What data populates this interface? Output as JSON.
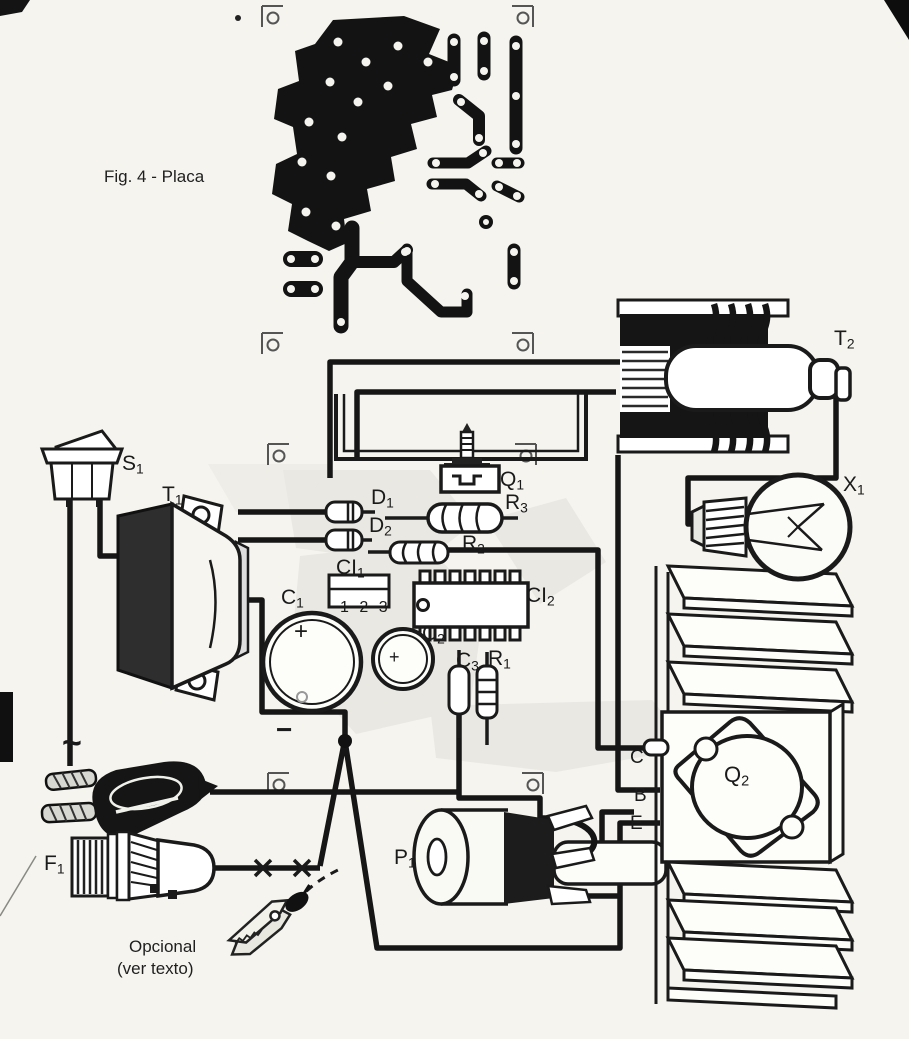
{
  "figure": {
    "caption": "Fig. 4 - Placa"
  },
  "notes": {
    "optional_line1": "Opcional",
    "optional_line2": "(ver texto)"
  },
  "colors": {
    "ink": "#1a1a1a",
    "paper": "#f5f4ef",
    "copper": "#131313",
    "watermark": "#e0dfd8"
  },
  "component_labels": [
    {
      "id": "s1",
      "main": "S",
      "sub": "1",
      "x": 122,
      "y": 453,
      "size": 21
    },
    {
      "id": "t1",
      "main": "T",
      "sub": "1",
      "x": 162,
      "y": 484,
      "size": 21
    },
    {
      "id": "t2",
      "main": "T",
      "sub": "2",
      "x": 834,
      "y": 328,
      "size": 21
    },
    {
      "id": "q1",
      "main": "Q",
      "sub": "1",
      "x": 500,
      "y": 469,
      "size": 21
    },
    {
      "id": "d1",
      "main": "D",
      "sub": "1",
      "x": 371,
      "y": 487,
      "size": 21
    },
    {
      "id": "d2",
      "main": "D",
      "sub": "2",
      "x": 369,
      "y": 515,
      "size": 21
    },
    {
      "id": "r3",
      "main": "R",
      "sub": "3",
      "x": 505,
      "y": 492,
      "size": 21
    },
    {
      "id": "r2",
      "main": "R",
      "sub": "2",
      "x": 462,
      "y": 533,
      "size": 21
    },
    {
      "id": "ci1",
      "main": "CI",
      "sub": "1",
      "x": 336,
      "y": 557,
      "size": 21
    },
    {
      "id": "ci1-pins",
      "main": "1 2 3",
      "sub": "",
      "x": 340,
      "y": 600,
      "size": 16,
      "cls": "pins"
    },
    {
      "id": "c1",
      "main": "C",
      "sub": "1",
      "x": 281,
      "y": 587,
      "size": 21
    },
    {
      "id": "ci2",
      "main": "CI",
      "sub": "2",
      "x": 526,
      "y": 585,
      "size": 21
    },
    {
      "id": "c2",
      "main": "C",
      "sub": "2",
      "x": 422,
      "y": 623,
      "size": 21
    },
    {
      "id": "c3",
      "main": "C",
      "sub": "3",
      "x": 456,
      "y": 650,
      "size": 21
    },
    {
      "id": "r1",
      "main": "R",
      "sub": "1",
      "x": 488,
      "y": 648,
      "size": 21
    },
    {
      "id": "x1",
      "main": "X",
      "sub": "1",
      "x": 843,
      "y": 474,
      "size": 21
    },
    {
      "id": "q2",
      "main": "Q",
      "sub": "2",
      "x": 724,
      "y": 764,
      "size": 22
    },
    {
      "id": "term-c",
      "main": "C",
      "sub": "",
      "x": 630,
      "y": 748,
      "size": 19
    },
    {
      "id": "term-b",
      "main": "B",
      "sub": "",
      "x": 634,
      "y": 786,
      "size": 19
    },
    {
      "id": "term-e",
      "main": "E",
      "sub": "",
      "x": 630,
      "y": 814,
      "size": 19
    },
    {
      "id": "p1",
      "main": "P",
      "sub": "1",
      "x": 394,
      "y": 847,
      "size": 21
    },
    {
      "id": "f1",
      "main": "F",
      "sub": "1",
      "x": 44,
      "y": 853,
      "size": 21
    },
    {
      "id": "ac-tilde",
      "main": "~",
      "sub": "",
      "x": 62,
      "y": 726,
      "size": 34,
      "bold": true
    },
    {
      "id": "minus",
      "main": "−",
      "sub": "",
      "x": 276,
      "y": 716,
      "size": 28,
      "bold": true
    },
    {
      "id": "plus-c1",
      "main": "+",
      "sub": "",
      "x": 294,
      "y": 620,
      "size": 24
    },
    {
      "id": "plus-c2",
      "main": "+",
      "sub": "",
      "x": 389,
      "y": 648,
      "size": 18
    }
  ]
}
